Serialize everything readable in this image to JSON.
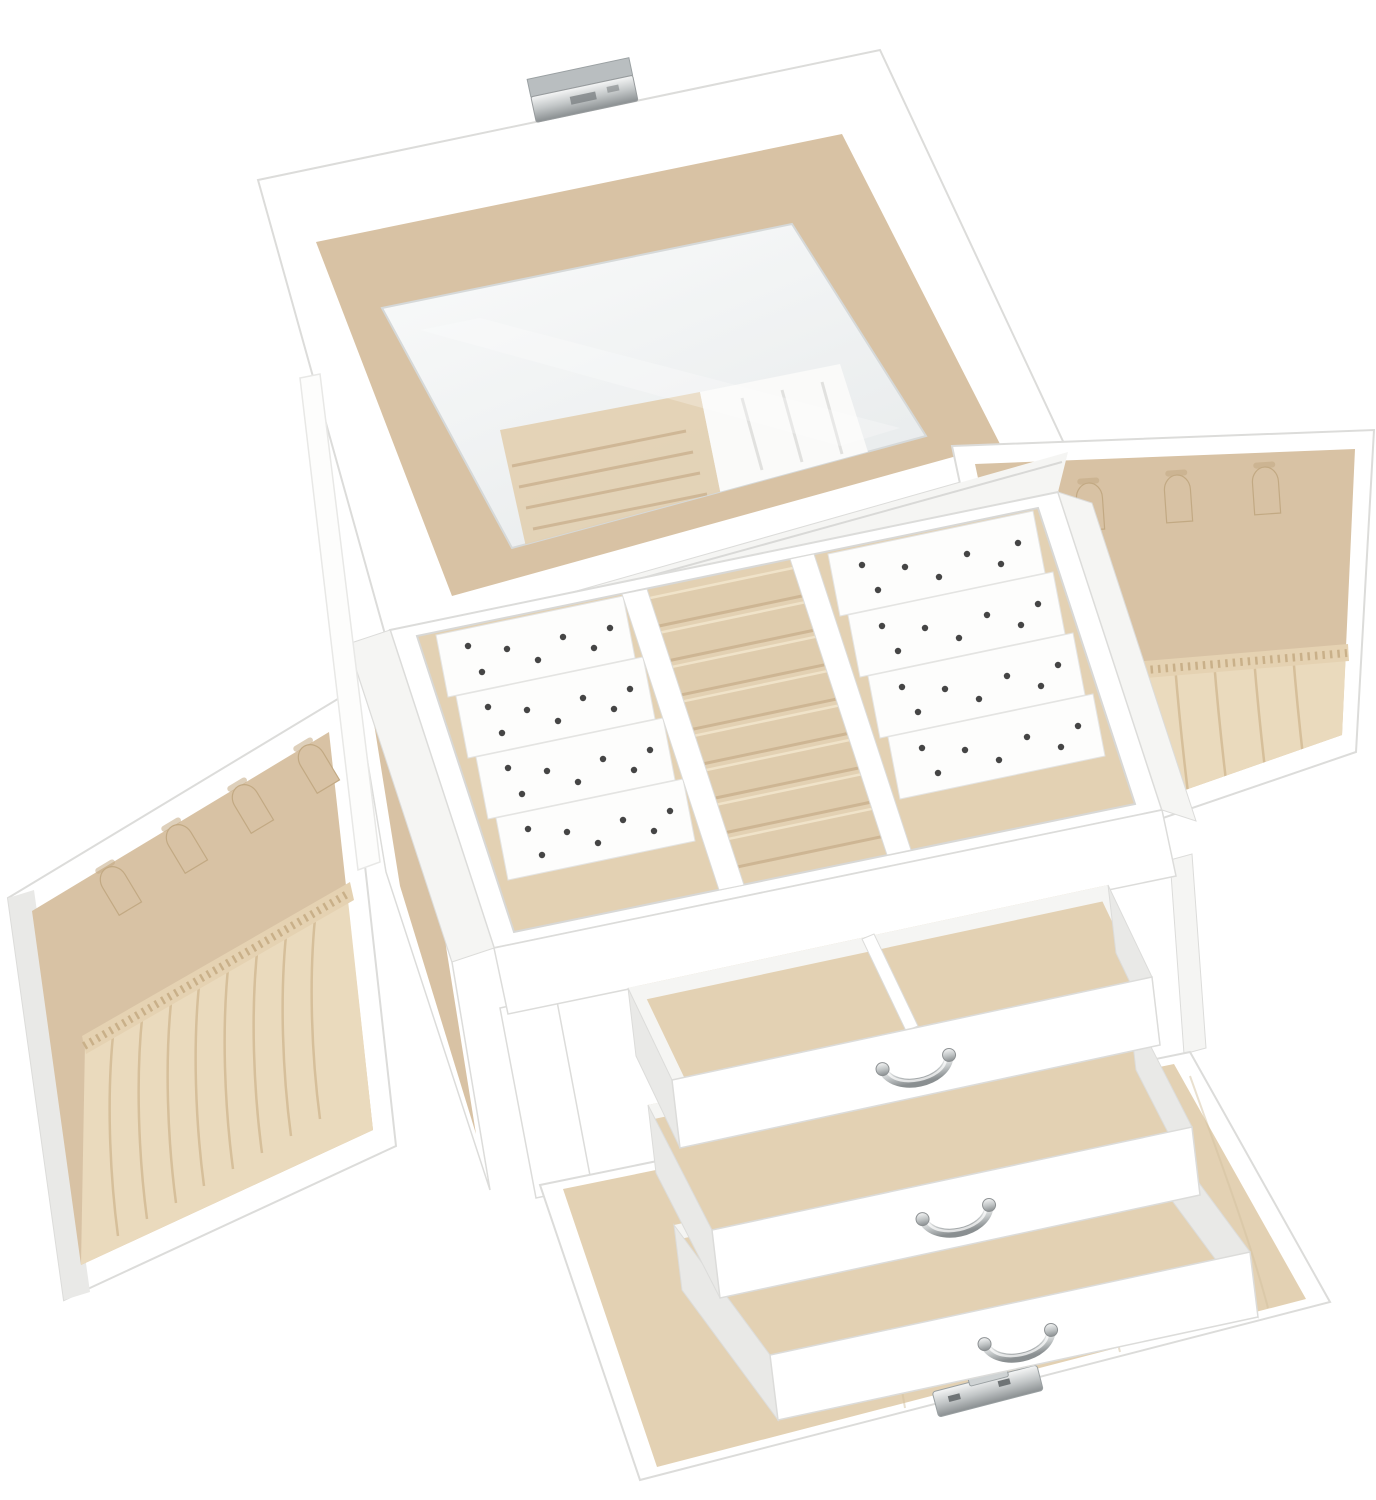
{
  "image": {
    "type": "product-photo",
    "subject": "White faux-leather jewelry organizer box shown fully open on a white background",
    "view": "three-quarter angled view"
  },
  "colors": {
    "background": "#ffffff",
    "box-white": "#ffffff",
    "white-soft": "#f5f5f3",
    "white-deep": "#e9e9e7",
    "edge-gray": "#dcdcda",
    "velvet": "#d8c2a4",
    "velvet-light": "#e3d1b3",
    "velvet-roll": "#dfccad",
    "roll-hi": "#f0e3c9",
    "roll-shadow": "#c8af8c",
    "velvet-dark": "#c2a983",
    "satin": "#eadabd",
    "satin-fold": "#d2ba94",
    "card-white": "#fdfdfc",
    "card-edge": "#e4e4e2",
    "hole-dark": "#454545",
    "mirror-hi": "#fafbfb",
    "mirror-lo": "#e8ebec",
    "silver-hi": "#f5f6f6",
    "silver-mid": "#c3c7c8",
    "silver-dark": "#8a8f91"
  },
  "parts": {
    "lid": {
      "state": "open",
      "mirror": true,
      "lining": "beige velvet border",
      "clasp": "polished silver latch on front edge"
    },
    "top_tray": {
      "left_earring_compartments": 4,
      "ring_rolls": 8,
      "right_earring_compartments": 4,
      "earring_cards": "white perforated dividers",
      "lining": "beige velvet"
    },
    "side_doors": {
      "count": 2,
      "state": "open",
      "hooks_per_door": 4,
      "hook_style": "beige velvet tab hooks",
      "pouch_per_door": "gathered elastic fabric pocket",
      "lining": "beige velvet"
    },
    "drawers": {
      "count": 3,
      "state": "pulled out, staggered",
      "lining": "beige velvet",
      "handles": "silver bail handle, one per drawer",
      "top_drawer_compartments": 2
    },
    "front_flap": {
      "state": "folded down flat",
      "lining": "beige velvet",
      "hardware": "silver latch plate on edge"
    },
    "strap": "white ribbon lid-support strap"
  }
}
